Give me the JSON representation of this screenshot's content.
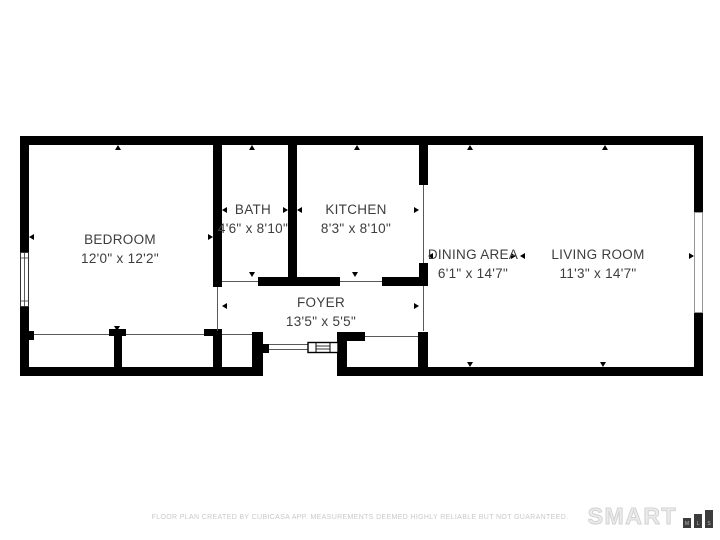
{
  "page": {
    "background": "#ffffff"
  },
  "floor_plan": {
    "wall_color": "#000000",
    "label_color": "#3d3d3d",
    "rooms": [
      {
        "id": "bedroom",
        "name": "BEDROOM",
        "dimensions": "12'0\" x 12'2\""
      },
      {
        "id": "bath",
        "name": "BATH",
        "dimensions": "4'6\" x 8'10\""
      },
      {
        "id": "kitchen",
        "name": "KITCHEN",
        "dimensions": "8'3\" x 8'10\""
      },
      {
        "id": "dining",
        "name": "DINING AREA",
        "dimensions": "6'1\" x 14'7\""
      },
      {
        "id": "living",
        "name": "LIVING ROOM",
        "dimensions": "11'3\" x 14'7\""
      },
      {
        "id": "foyer",
        "name": "FOYER",
        "dimensions": "13'5\" x 5'5\""
      }
    ]
  },
  "footer": {
    "disclaimer": "FLOOR PLAN CREATED BY CUBICASA APP. MEASUREMENTS DEEMED HIGHLY RELIABLE BUT NOT GUARANTEED.",
    "disclaimer_color": "#c9c9c9",
    "logo_text": "SMART",
    "logo_text_color": "#d2d2d2",
    "logo_bars": [
      "M",
      "L",
      "S"
    ],
    "logo_bar_color": "#3d3d3d"
  }
}
